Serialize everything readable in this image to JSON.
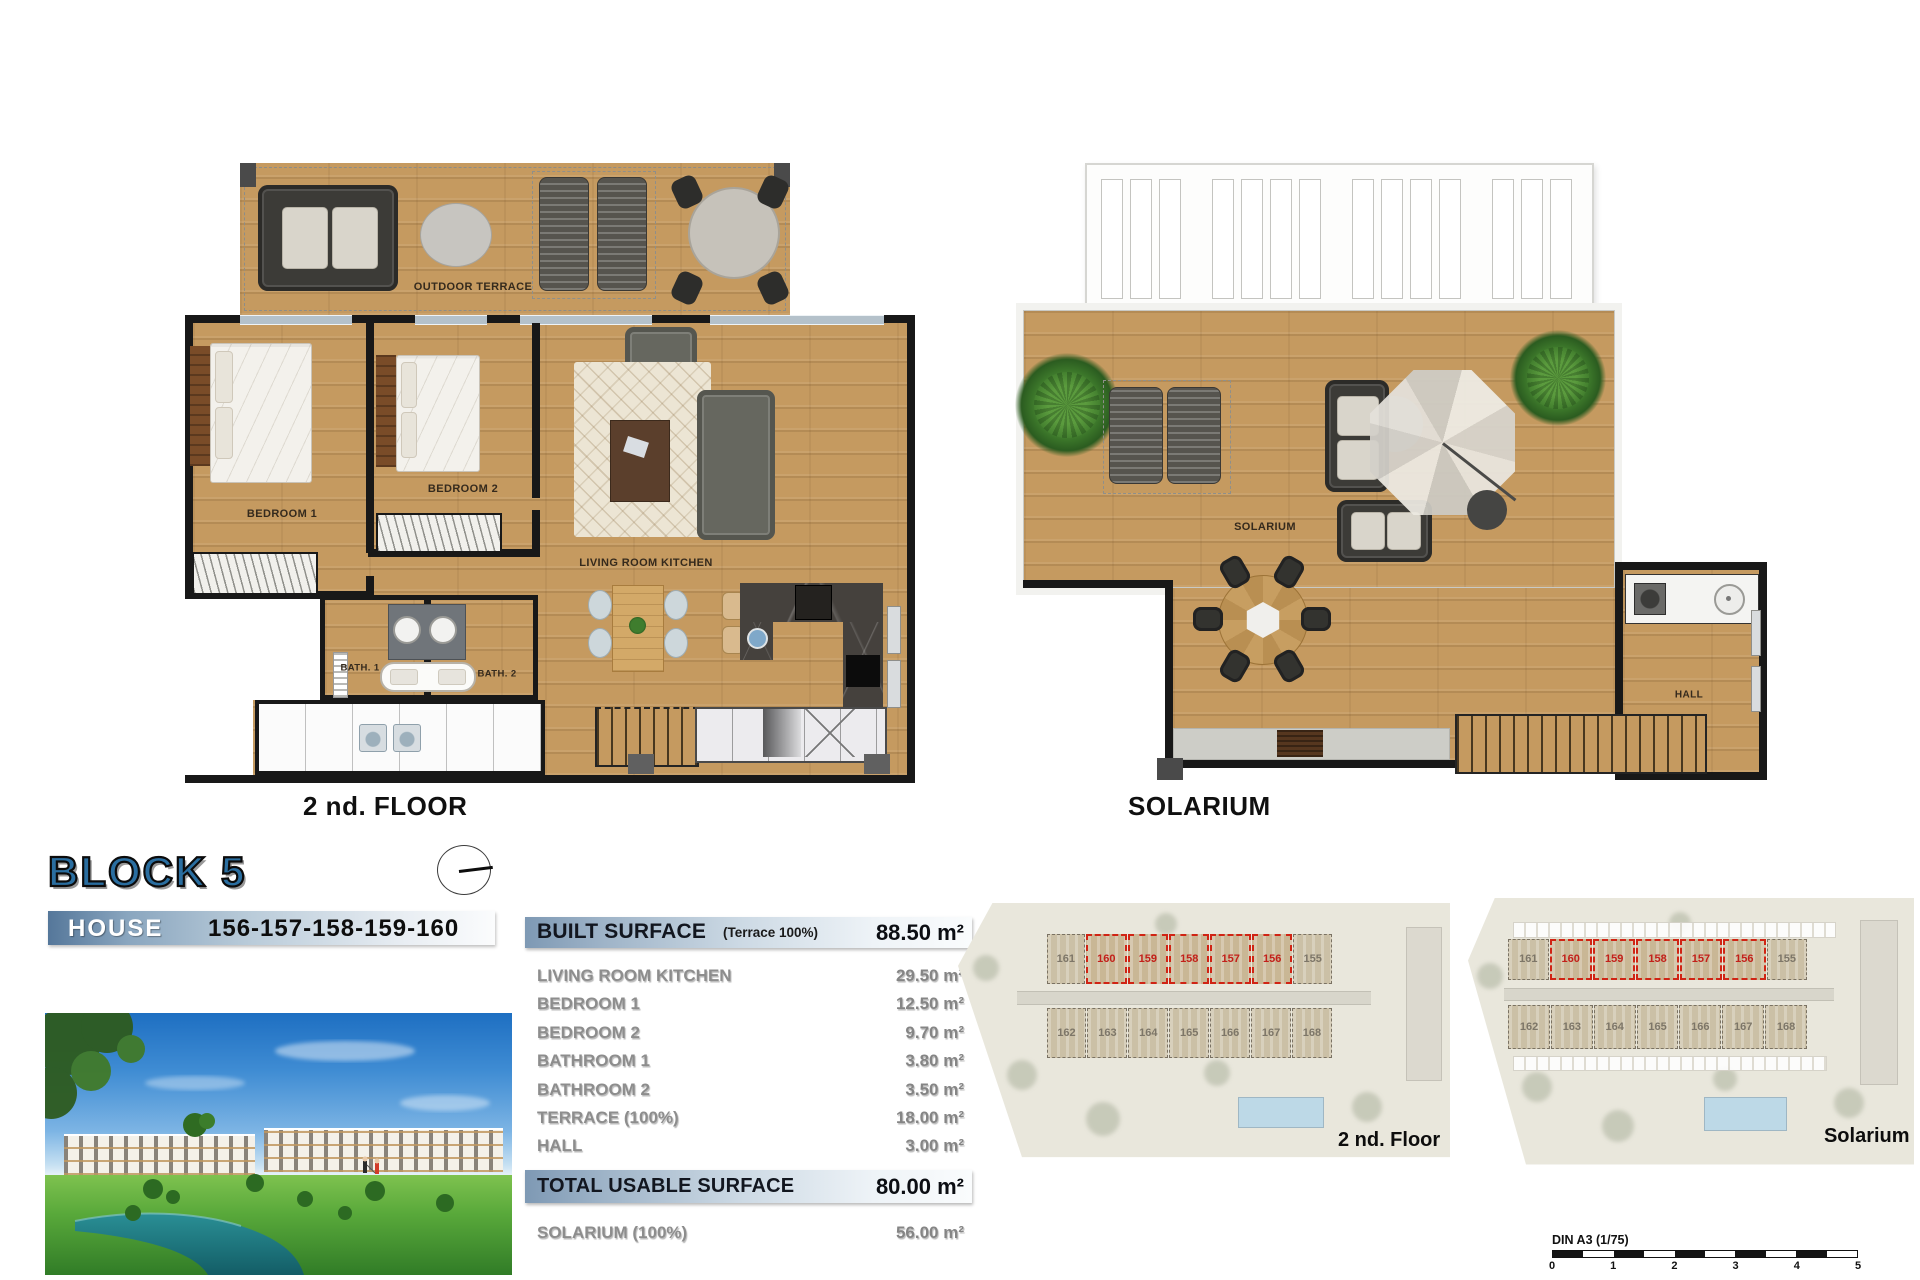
{
  "floor_plan": {
    "title": "2 nd. FLOOR",
    "labels": {
      "outdoor_terrace": "OUTDOOR TERRACE",
      "bedroom1": "BEDROOM 1",
      "bedroom2": "BEDROOM 2",
      "living_room_kitchen": "LIVING ROOM KITCHEN",
      "bath1": "BATH. 1",
      "bath2": "BATH. 2"
    }
  },
  "solarium_plan": {
    "title": "SOLARIUM",
    "labels": {
      "solarium": "SOLARIUM",
      "hall": "HALL"
    }
  },
  "block": {
    "title": "BLOCK 5",
    "house_label": "HOUSE",
    "house_numbers": "156-157-158-159-160"
  },
  "surface_table": {
    "header": {
      "label": "BUILT SURFACE",
      "note": "(Terrace 100%)",
      "value": "88.50 m²"
    },
    "rows": [
      {
        "label": "LIVING ROOM KITCHEN",
        "value": "29.50 m²"
      },
      {
        "label": "BEDROOM 1",
        "value": "12.50 m²"
      },
      {
        "label": "BEDROOM 2",
        "value": "9.70 m²"
      },
      {
        "label": "BATHROOM 1",
        "value": "3.80 m²"
      },
      {
        "label": "BATHROOM 2",
        "value": "3.50 m²"
      },
      {
        "label": "TERRACE (100%)",
        "value": "18.00 m²"
      },
      {
        "label": "HALL",
        "value": "3.00 m²"
      }
    ],
    "total": {
      "label": "TOTAL USABLE SURFACE",
      "value": "80.00 m²"
    },
    "solarium_row": {
      "label": "SOLARIUM (100%)",
      "value": "56.00 m²"
    }
  },
  "site_plans": [
    {
      "label": "2 nd. Floor",
      "units_top": [
        "161",
        "160",
        "159",
        "158",
        "157",
        "156",
        "155"
      ],
      "units_bottom": [
        "162",
        "163",
        "164",
        "165",
        "166",
        "167",
        "168"
      ],
      "highlighted_units": [
        "160",
        "159",
        "158",
        "157",
        "156"
      ]
    },
    {
      "label": "Solarium",
      "units_top": [
        "161",
        "160",
        "159",
        "158",
        "157",
        "156",
        "155"
      ],
      "units_bottom": [
        "162",
        "163",
        "164",
        "165",
        "166",
        "167",
        "168"
      ],
      "highlighted_units": [
        "160",
        "159",
        "158",
        "157",
        "156"
      ]
    }
  ],
  "scale_bar": {
    "label": "DIN A3 (1/75)",
    "ticks": [
      "0",
      "1",
      "2",
      "3",
      "4",
      "5"
    ]
  },
  "colors": {
    "accent_blue": "#2a6ea0",
    "highlight_red": "#c3201a",
    "wood": "#c59a60",
    "bar_gradient_start": "#7e99b4",
    "bar_gradient_end": "#fafcfd"
  }
}
